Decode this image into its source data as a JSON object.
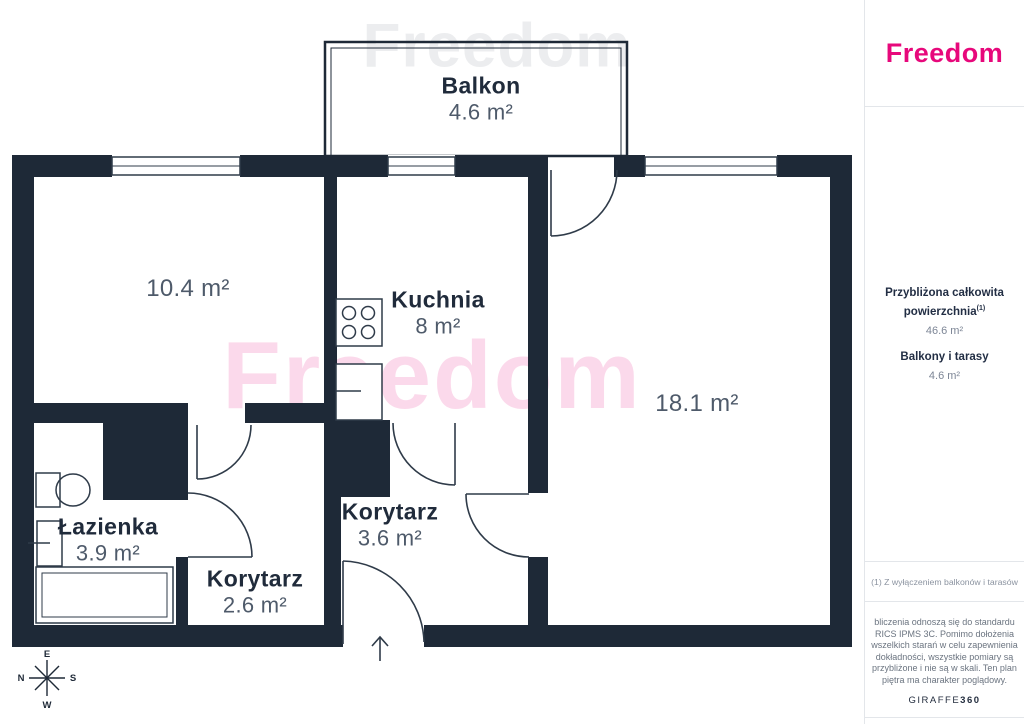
{
  "brand": {
    "logo": "Freedom",
    "watermark": "Freedom",
    "accent_color": "#e7087b",
    "wall_color": "#1e2937"
  },
  "floorplan": {
    "rooms": {
      "balkon": {
        "name": "Balkon",
        "area": "4.6 m²"
      },
      "room_10_4": {
        "area": "10.4 m²"
      },
      "kuchnia": {
        "name": "Kuchnia",
        "area": "8 m²"
      },
      "room_18_1": {
        "area": "18.1 m²"
      },
      "lazienka": {
        "name": "Łazienka",
        "area": "3.9 m²"
      },
      "korytarz_a": {
        "name": "Korytarz",
        "area": "3.6 m²"
      },
      "korytarz_b": {
        "name": "Korytarz",
        "area": "2.6 m²"
      }
    },
    "compass": {
      "top": "E",
      "left": "N",
      "right": "S",
      "bottom": "W"
    }
  },
  "sidebar": {
    "summary": {
      "total_label_line1": "Przybliżona całkowita",
      "total_label_line2": "powierzchnia",
      "total_superscript": "(1)",
      "total_value": "46.6 m²",
      "balcony_label": "Balkony i tarasy",
      "balcony_value": "4.6 m²"
    },
    "footnote": "(1) Z wyłączeniem balkonów i tarasów",
    "disclaimer_lines": [
      "bliczenia odnoszą się do standardu",
      "RICS IPMS 3C. Pomimo dołożenia",
      "wszelkich starań w celu zapewnienia",
      "dokładności, wszystkie pomiary są",
      "przybliżone i nie są w skali. Ten plan",
      "piętra ma charakter poglądowy."
    ],
    "giraffe_normal": "GIRAFFE",
    "giraffe_bold": "360"
  }
}
